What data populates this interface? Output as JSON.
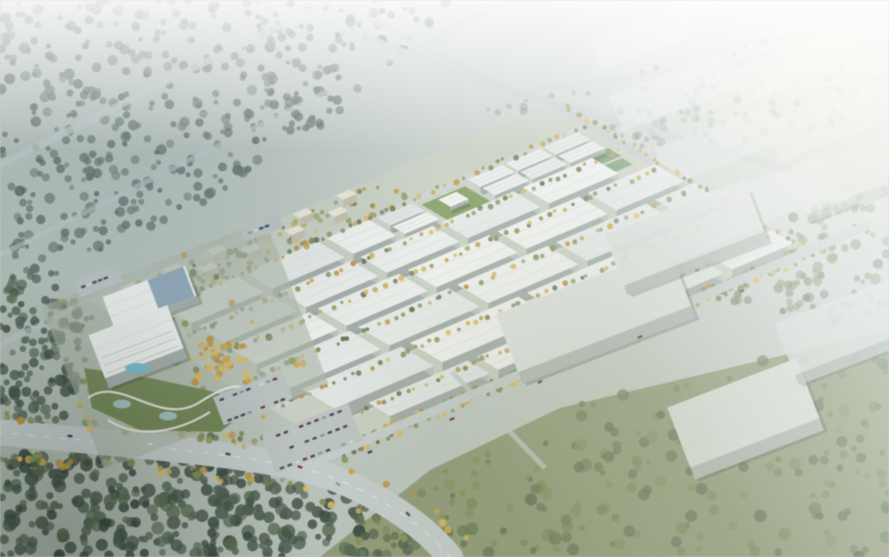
{
  "image": {
    "description_role": "aerial-architectural-rendering",
    "subject": "industrial-logistics-park-masterplan",
    "visible_text": "none"
  },
  "scene": {
    "seed": 7,
    "canvas": {
      "w": 889,
      "h": 557
    },
    "basis": {
      "origin": [
        148,
        318
      ],
      "u": [
        0.9,
        -0.385
      ],
      "v": [
        0.6,
        0.355
      ]
    },
    "palette": {
      "groundA": "#a9b5ab",
      "groundB": "#d6dcd7",
      "roofs": [
        "#eaede9",
        "#e4e9e6",
        "#eff1ed",
        "#dfe4e2"
      ],
      "facade": "#9fa8a3",
      "facadeEnd": "#b7bfba",
      "shadow": "rgba(55,65,58,0.32)",
      "parkBase": "#c6cdbf",
      "street": "#cbd2cf",
      "treeGreens": [
        "#6d7c49",
        "#7d8c50",
        "#5f6e44",
        "#8a9657"
      ],
      "treeYellows": [
        "#c8a346",
        "#d9b458",
        "#b98f3e"
      ],
      "forestCool": [
        "#4f6057",
        "#5b6c5f",
        "#475649",
        "#66766a"
      ],
      "forestDark": [
        "#3f4f43",
        "#4b5b4c",
        "#57684f",
        "#36443b"
      ],
      "grassBase": "#87916a",
      "grassTrees": [
        "#55644a",
        "#62724e",
        "#71814f",
        "#7d8a55"
      ],
      "horizon": [
        "#6f7f72",
        "#7d8d80",
        "#5f6f63"
      ],
      "roadLight": "#bec7c8",
      "roadWide": "#c2cac9",
      "laneMark": "#e9ecea",
      "resWall": "#ece7d7",
      "resFacade": "#c2bba6",
      "lawn": "#7f9b5e",
      "field": "#5f8f5a",
      "poolBlue": "#6fb9cf",
      "pondBlue": "#9fc3c9",
      "hallRoofBlue": "#7e99ad",
      "campusGround": "#a8b3a0",
      "gardenGreen": "#6e824f",
      "pathWhite": "#e8e9e4",
      "lotGrey": "#b9c1bf",
      "distantBox": "#e2e7e8",
      "eastRoof": "#dce0dc",
      "eastFacade": "#aeb6b1",
      "carColors": [
        "#39414a",
        "#6b3232",
        "#d2d6d8",
        "#2f3e57",
        "#8b929a",
        "#4c4c44"
      ]
    },
    "grassRegion": [
      [
        320,
        557
      ],
      [
        430,
        470
      ],
      [
        560,
        408
      ],
      [
        889,
        330
      ],
      [
        889,
        557
      ]
    ],
    "forests": [
      {
        "name": "forest-top-left",
        "poly": [
          [
            0,
            0
          ],
          [
            460,
            0
          ],
          [
            330,
            120
          ],
          [
            210,
            200
          ],
          [
            60,
            268
          ],
          [
            0,
            290
          ]
        ],
        "n": 430,
        "r": [
          2.2,
          5.5
        ],
        "pal": "forestCool",
        "op": 0.8
      },
      {
        "name": "forest-left-mid",
        "poly": [
          [
            0,
            290
          ],
          [
            60,
            268
          ],
          [
            95,
            320
          ],
          [
            70,
            420
          ],
          [
            0,
            440
          ]
        ],
        "n": 130,
        "r": [
          2.5,
          6
        ],
        "pal": "forestDark",
        "op": 0.85
      },
      {
        "name": "forest-bottom-left",
        "poly": [
          [
            0,
            455
          ],
          [
            140,
            452
          ],
          [
            320,
            472
          ],
          [
            430,
            557
          ],
          [
            0,
            557
          ]
        ],
        "n": 330,
        "r": [
          3,
          7
        ],
        "pal": "forestDark",
        "op": 0.9
      },
      {
        "name": "grass-trees-bottom-right",
        "poly": [
          [
            320,
            557
          ],
          [
            430,
            470
          ],
          [
            560,
            408
          ],
          [
            889,
            330
          ],
          [
            889,
            557
          ]
        ],
        "n": 220,
        "r": [
          2.5,
          6.5
        ],
        "pal": "grassTrees",
        "op": 0.8
      },
      {
        "name": "horizon-tree-band",
        "poly": [
          [
            470,
            110
          ],
          [
            889,
            10
          ],
          [
            889,
            120
          ],
          [
            620,
            160
          ]
        ],
        "n": 150,
        "r": [
          2,
          4.5
        ],
        "pal": "horizon",
        "op": 0.5
      },
      {
        "name": "grove-ne-mid",
        "poly": [
          [
            800,
            210
          ],
          [
            889,
            190
          ],
          [
            889,
            330
          ],
          [
            700,
            310
          ]
        ],
        "n": 90,
        "r": [
          2.5,
          5.5
        ],
        "pal": "grassTrees",
        "op": 0.7
      }
    ],
    "highways": [
      {
        "pts": [
          [
            0,
            165
          ],
          [
            330,
            0
          ]
        ],
        "w": 7,
        "op": 0.75
      },
      {
        "pts": [
          [
            0,
            255
          ],
          [
            510,
            0
          ]
        ],
        "w": 5,
        "op": 0.6
      },
      {
        "pts": [
          [
            0,
            345
          ],
          [
            150,
            268
          ]
        ],
        "w": 5,
        "op": 0.55
      },
      {
        "pts": [
          [
            260,
            0
          ],
          [
            517,
            93
          ],
          [
            889,
            198
          ]
        ],
        "w": 8,
        "op": 0.8
      },
      {
        "pts": [
          [
            517,
            93
          ],
          [
            889,
            40
          ]
        ],
        "w": 5,
        "op": 0.55
      },
      {
        "pts": [
          [
            330,
            0
          ],
          [
            517,
            93
          ]
        ],
        "w": 6,
        "op": 0.7
      }
    ],
    "park": {
      "basePoly": [
        [
          -20,
          -70
        ],
        [
          500,
          -70
        ],
        [
          500,
          350
        ],
        [
          -20,
          350
        ]
      ],
      "streetsB": [
        56,
        112,
        172,
        236,
        302
      ],
      "crossA": [
        108,
        218,
        328
      ],
      "rows": [
        {
          "b": 6,
          "d": 20,
          "h": 5,
          "bld": [
            [
              252,
              290
            ],
            [
              352,
              390
            ],
            [
              394,
              432
            ],
            [
              436,
              474
            ]
          ]
        },
        {
          "b": 30,
          "d": 20,
          "h": 5,
          "bld": [
            [
              252,
              290
            ],
            [
              352,
              390
            ],
            [
              394,
              432
            ],
            [
              436,
              474
            ]
          ]
        },
        {
          "b": 6,
          "d": 44,
          "h": 7,
          "bld": [
            [
              15,
              95
            ],
            [
              105,
              185
            ],
            [
              195,
              242
            ]
          ]
        },
        {
          "b": 62,
          "d": 44,
          "h": 8,
          "bld": [
            [
              15,
              95
            ],
            [
              105,
              185
            ],
            [
              195,
              275
            ],
            [
              285,
              365
            ],
            [
              375,
              452
            ]
          ]
        },
        {
          "b": 118,
          "d": 48,
          "h": 9,
          "bld": [
            [
              10,
              100
            ],
            [
              110,
              200
            ],
            [
              210,
              300
            ],
            [
              310,
              400
            ],
            [
              410,
              485
            ]
          ]
        },
        {
          "b": 178,
          "d": 52,
          "h": 10,
          "bld": [
            [
              5,
              105
            ],
            [
              115,
              215
            ],
            [
              225,
              325
            ],
            [
              335,
              435
            ],
            [
              445,
              488
            ]
          ]
        },
        {
          "b": 242,
          "d": 54,
          "h": 11,
          "bld": [
            [
              10,
              120
            ],
            [
              130,
              250
            ],
            [
              260,
              380
            ],
            [
              390,
              488
            ]
          ]
        },
        {
          "b": 308,
          "d": 36,
          "h": 9,
          "bld": [
            [
              40,
              150
            ],
            [
              160,
              280
            ],
            [
              290,
              410
            ],
            [
              420,
              488
            ]
          ]
        }
      ],
      "lawn": {
        "a": [
          300,
          348
        ],
        "b": [
          6,
          50
        ]
      },
      "hut": {
        "a": [
          312,
          332
        ],
        "b": [
          16,
          36
        ],
        "h": 4
      },
      "fields": [
        {
          "a": [
            450,
            482
          ],
          "b": [
            44,
            66
          ]
        },
        {
          "a": [
            452,
            480
          ],
          "b": [
            70,
            88
          ]
        }
      ]
    },
    "residential": {
      "a0": 6,
      "count": 11,
      "step": 24,
      "rowsB": [
        -56,
        -34
      ],
      "len": 15,
      "depth": 12,
      "h": 8,
      "treesPoly": [
        [
          -6,
          -62
        ],
        [
          300,
          -62
        ],
        [
          300,
          -8
        ],
        [
          -6,
          -8
        ]
      ],
      "treeN": 110
    },
    "neAvenue": {
      "a": 494,
      "bRange": [
        -70,
        348
      ],
      "w": 7
    },
    "boundaryRoad": {
      "b": 352,
      "aRange": [
        -62,
        562
      ],
      "w": 9
    },
    "spur": {
      "pts": [
        [
          452,
          372
        ],
        [
          545,
          468
        ]
      ],
      "w": 5
    },
    "wideRoad": {
      "path": "M -5 432 C 120 444 230 452 300 468 C 360 482 420 520 450 557",
      "w": 26,
      "vergePts": [
        [
          0,
          437
        ],
        [
          160,
          448
        ],
        [
          300,
          468
        ],
        [
          420,
          520
        ],
        [
          450,
          557
        ]
      ]
    },
    "campus": {
      "ground": {
        "cx": 185,
        "cy": 345,
        "w": 240,
        "h": 175,
        "rot": -21
      },
      "scatterPoly": [
        [
          60,
          300
        ],
        [
          190,
          245
        ],
        [
          330,
          370
        ],
        [
          250,
          452
        ],
        [
          80,
          430
        ]
      ],
      "treeN": 60,
      "garden": {
        "poly": [
          [
            84,
            368
          ],
          [
            150,
            378
          ],
          [
            215,
            392
          ],
          [
            248,
            410
          ],
          [
            220,
            432
          ],
          [
            140,
            430
          ],
          [
            92,
            408
          ]
        ]
      },
      "ponds": [
        [
          122,
          404
        ],
        [
          168,
          416
        ]
      ],
      "paths": [
        "M 88 398 C 120 374 160 428 200 402 S 246 388 258 400",
        "M 108 420 C 138 440 178 432 210 412"
      ],
      "grove": {
        "poly": [
          [
            185,
            335
          ],
          [
            245,
            345
          ],
          [
            250,
            385
          ],
          [
            195,
            382
          ]
        ],
        "n": 45
      },
      "hall": {
        "cx": 152,
        "cy": 303,
        "w": 88,
        "hh": 32,
        "rot": -21,
        "h3": 7
      },
      "hq": {
        "cx": 140,
        "cy": 352,
        "w": 84,
        "hh": 46,
        "rot": -21,
        "h3": 11
      },
      "pool": {
        "cx": 137,
        "cy": 368,
        "rx": 12,
        "ry": 5
      }
    },
    "lots": [
      {
        "cx": 253,
        "cy": 398,
        "w": 74,
        "h": 30,
        "rot": -21,
        "rows": 2,
        "cols": 9
      },
      {
        "cx": 98,
        "cy": 281,
        "w": 46,
        "h": 18,
        "rot": -21,
        "rows": 1,
        "cols": 6
      },
      {
        "cx": 312,
        "cy": 438,
        "w": 92,
        "h": 40,
        "rot": -21,
        "rows": 3,
        "cols": 10
      },
      {
        "cx": 262,
        "cy": 228,
        "w": 40,
        "h": 14,
        "rot": -21,
        "rows": 1,
        "cols": 5
      }
    ],
    "east": [
      {
        "cx": 598,
        "cy": 322,
        "w": 185,
        "hh": 62,
        "rot": -21,
        "h3": 13,
        "op": 1
      },
      {
        "cx": 688,
        "cy": 243,
        "w": 150,
        "hh": 55,
        "rot": -21,
        "h3": 11,
        "op": 0.92
      },
      {
        "cx": 748,
        "cy": 425,
        "w": 138,
        "hh": 64,
        "rot": -21,
        "h3": 13,
        "op": 1
      },
      {
        "cx": 845,
        "cy": 338,
        "w": 120,
        "hh": 55,
        "rot": -21,
        "h3": 11,
        "op": 0.85
      },
      {
        "cx": 852,
        "cy": 182,
        "w": 110,
        "hh": 45,
        "rot": -21,
        "h3": 9,
        "op": 0.6
      }
    ],
    "distant": [
      {
        "cx": 672,
        "cy": 92,
        "w": 120,
        "h": 38
      },
      {
        "cx": 795,
        "cy": 65,
        "w": 120,
        "h": 38
      },
      {
        "cx": 712,
        "cy": 148,
        "w": 130,
        "h": 40
      },
      {
        "cx": 832,
        "cy": 120,
        "w": 125,
        "h": 40
      },
      {
        "cx": 768,
        "cy": 198,
        "w": 130,
        "h": 42
      },
      {
        "cx": 642,
        "cy": 38,
        "w": 100,
        "h": 32
      }
    ],
    "roadCars": [
      [
        70,
        436,
        4
      ],
      [
        150,
        444,
        7
      ],
      [
        228,
        454,
        11
      ],
      [
        338,
        484,
        32
      ],
      [
        408,
        514,
        46
      ],
      [
        300,
        467,
        20
      ],
      [
        452,
        419,
        -24
      ],
      [
        540,
        382,
        -24
      ],
      [
        640,
        337,
        -24
      ],
      [
        742,
        291,
        -24
      ],
      [
        800,
        250,
        -24
      ],
      [
        370,
        452,
        -24
      ]
    ],
    "hazeStops": [
      [
        0,
        0
      ],
      [
        0.42,
        0.06
      ],
      [
        0.62,
        0.22
      ],
      [
        0.8,
        0.5
      ],
      [
        1,
        0.82
      ]
    ]
  }
}
